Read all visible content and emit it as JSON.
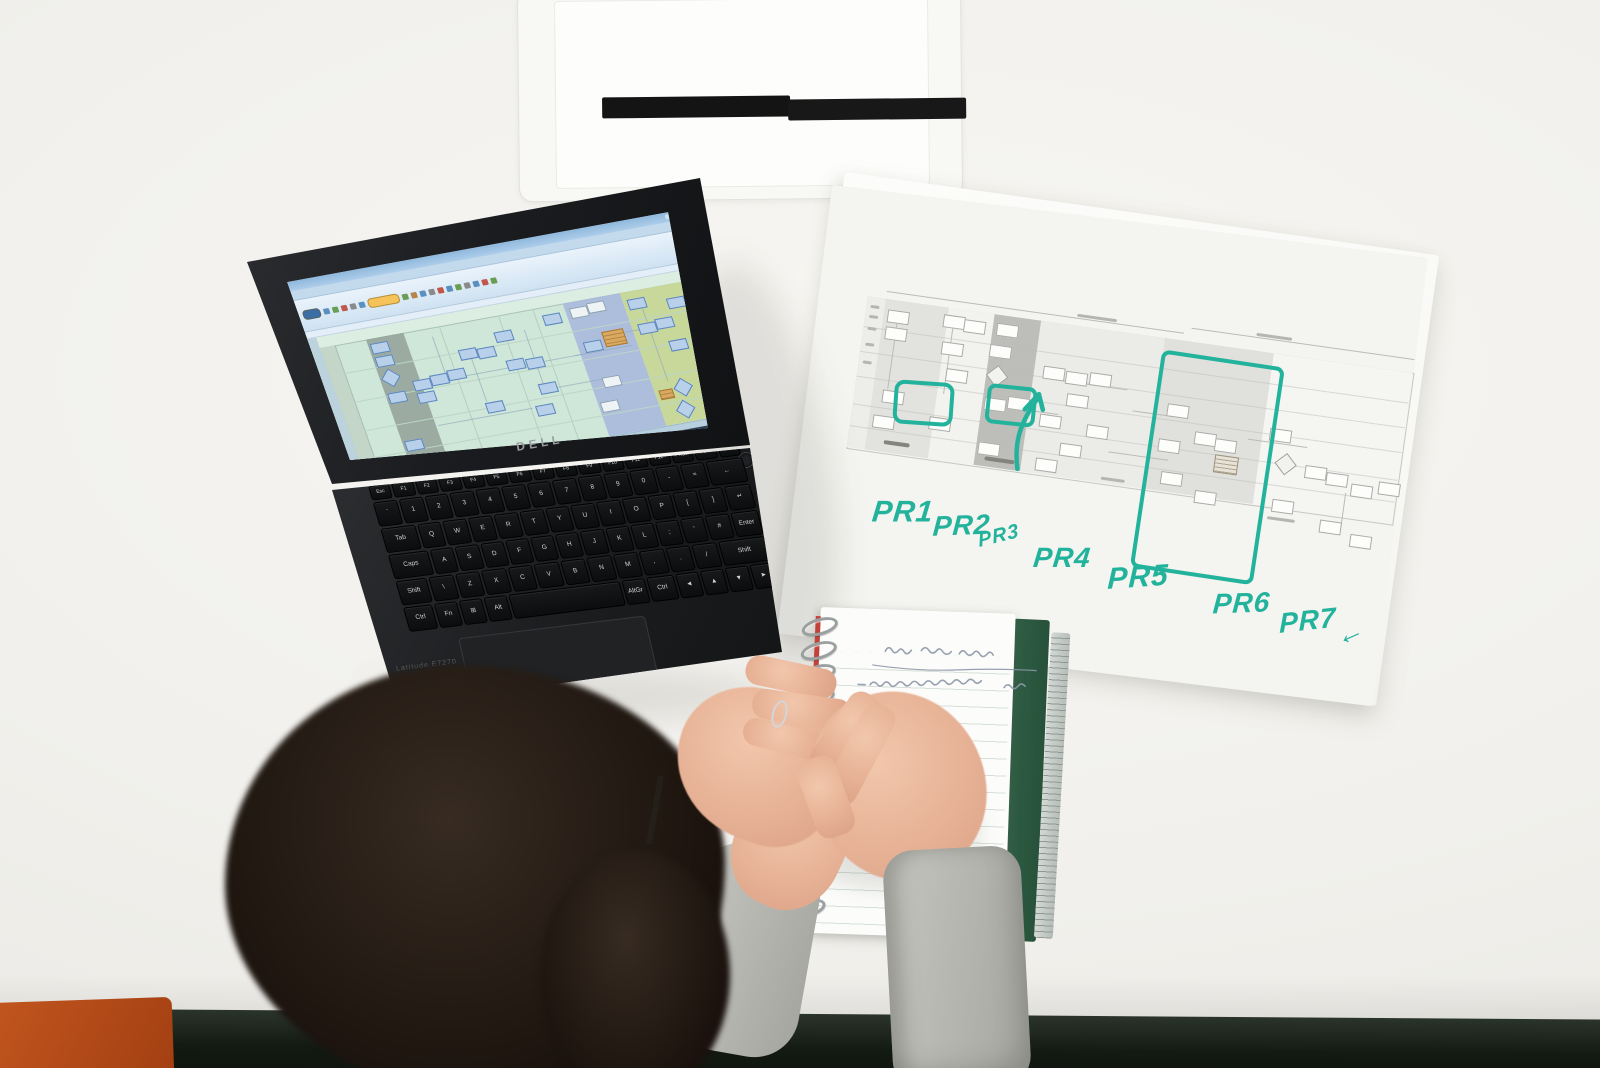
{
  "scene": {
    "description": "Overhead photo of a person taking handwritten notes at a white desk beside a Dell laptop displaying a swimlane process flowchart, next to a printed process map annotated with teal marker labels PR1 through PR7"
  },
  "palette": {
    "desk": "#f1f0ec",
    "desk_edge": "#131a12",
    "chair": "#b8501f",
    "marker_teal": "#23b39c",
    "skin": "#e7b296",
    "sleeve": "#b7b7b1",
    "hair": "#241b14",
    "pen": "#141414",
    "notebook_cover": "#2e5c43",
    "notebook_ink": "#8e98a9"
  },
  "laptop": {
    "brand_logo": "DELL",
    "model_label": "Latitude E7270",
    "screen": {
      "chrome_color": "#9dc0e0",
      "canvas_color": "#cfe7d8",
      "ribbon_icons": [
        {
          "c": "#3a6ea5",
          "w": 16,
          "pill": true
        },
        {
          "c": "#5b8fc0"
        },
        {
          "c": "#6b9e55"
        },
        {
          "c": "#c0574a"
        },
        {
          "c": "#8a8a8a"
        },
        {
          "c": "#5b8fc0"
        },
        {
          "c": "#f5c35a",
          "w": 30,
          "pill": true
        },
        {
          "c": "#6b9e55"
        },
        {
          "c": "#b5864a"
        },
        {
          "c": "#5b8fc0"
        },
        {
          "c": "#8a8a8a"
        },
        {
          "c": "#c0574a"
        },
        {
          "c": "#5b8fc0"
        },
        {
          "c": "#6b9e55"
        },
        {
          "c": "#8a8a8a"
        },
        {
          "c": "#5b8fc0"
        },
        {
          "c": "#c0574a"
        },
        {
          "c": "#6b9e55"
        }
      ],
      "lanes": [
        {
          "x": 56,
          "w": 38,
          "c": "#96a49c"
        },
        {
          "x": 256,
          "w": 58,
          "c": "#a9b9de"
        },
        {
          "x": 314,
          "w": 86,
          "c": "#c6d693"
        }
      ],
      "gridx": [
        130,
        190,
        225
      ],
      "gridy": [
        40,
        70,
        100,
        128
      ],
      "shapes": [
        {
          "x": 58,
          "y": 16,
          "t": "b"
        },
        {
          "x": 58,
          "y": 30,
          "t": "b"
        },
        {
          "x": 60,
          "y": 46,
          "t": "d"
        },
        {
          "x": 58,
          "y": 68,
          "t": "b"
        },
        {
          "x": 58,
          "y": 118,
          "t": "b"
        },
        {
          "x": 86,
          "y": 60,
          "t": "b"
        },
        {
          "x": 86,
          "y": 73,
          "t": "b"
        },
        {
          "x": 104,
          "y": 58,
          "t": "b"
        },
        {
          "x": 122,
          "y": 56,
          "t": "b"
        },
        {
          "x": 140,
          "y": 38,
          "t": "b"
        },
        {
          "x": 158,
          "y": 40,
          "t": "b"
        },
        {
          "x": 180,
          "y": 27,
          "t": "b"
        },
        {
          "x": 182,
          "y": 57,
          "t": "b"
        },
        {
          "x": 201,
          "y": 59,
          "t": "b"
        },
        {
          "x": 205,
          "y": 86,
          "t": "b"
        },
        {
          "x": 195,
          "y": 107,
          "t": "b"
        },
        {
          "x": 148,
          "y": 95,
          "t": "b"
        },
        {
          "x": 232,
          "y": 19,
          "t": "b"
        },
        {
          "x": 260,
          "y": 17,
          "t": "w"
        },
        {
          "x": 278,
          "y": 15,
          "t": "w"
        },
        {
          "x": 262,
          "y": 53,
          "t": "b"
        },
        {
          "x": 283,
          "y": 46,
          "t": "o"
        },
        {
          "x": 268,
          "y": 91,
          "t": "w"
        },
        {
          "x": 258,
          "y": 115,
          "t": "w"
        },
        {
          "x": 318,
          "y": 19,
          "t": "b"
        },
        {
          "x": 320,
          "y": 45,
          "t": "b"
        },
        {
          "x": 338,
          "y": 43,
          "t": "b"
        },
        {
          "x": 356,
          "y": 25,
          "t": "b"
        },
        {
          "x": 344,
          "y": 67,
          "t": "b"
        },
        {
          "x": 318,
          "y": 114,
          "t": "o2"
        },
        {
          "x": 336,
          "y": 108,
          "t": "d"
        },
        {
          "x": 362,
          "y": 104,
          "t": "b"
        },
        {
          "x": 376,
          "y": 37,
          "t": "b"
        },
        {
          "x": 331,
          "y": 130,
          "t": "d"
        }
      ],
      "lines": [
        {
          "x": 90,
          "y": 64,
          "w": 168,
          "h": 1
        },
        {
          "x": 120,
          "y": 20,
          "w": 1,
          "h": 42
        },
        {
          "x": 210,
          "y": 30,
          "w": 1,
          "h": 58
        },
        {
          "x": 250,
          "y": 64,
          "w": 58,
          "h": 1
        },
        {
          "x": 306,
          "y": 50,
          "w": 40,
          "h": 1
        },
        {
          "x": 330,
          "y": 30,
          "w": 1,
          "h": 76
        },
        {
          "x": 370,
          "y": 46,
          "w": 1,
          "h": 58
        },
        {
          "x": 150,
          "y": 46,
          "w": 1,
          "h": 48
        },
        {
          "x": 96,
          "y": 108,
          "w": 96,
          "h": 1
        },
        {
          "x": 222,
          "y": 92,
          "w": 56,
          "h": 1
        }
      ],
      "taskbar_color": "#2e4058",
      "task_dots": [
        "#4a90d9",
        "#e8a33d",
        "#6bbf6b",
        "#d95f4a",
        "#8ab4d8",
        "#c8c8c8"
      ]
    },
    "keyboard": {
      "rows": [
        {
          "h": 15,
          "keys": [
            {
              "t": "Esc"
            },
            {
              "t": "F1"
            },
            {
              "t": "F2"
            },
            {
              "t": "F3"
            },
            {
              "t": "F4"
            },
            {
              "t": "F5"
            },
            {
              "t": "F6"
            },
            {
              "t": "F7"
            },
            {
              "t": "F8"
            },
            {
              "t": "F9"
            },
            {
              "t": "F10"
            },
            {
              "t": "F11"
            },
            {
              "t": "F12"
            },
            {
              "t": "PrtScr"
            },
            {
              "t": "Insert"
            },
            {
              "t": "Delete"
            }
          ]
        },
        {
          "h": 25,
          "keys": [
            {
              "t": "`"
            },
            {
              "t": "1"
            },
            {
              "t": "2"
            },
            {
              "t": "3"
            },
            {
              "t": "4"
            },
            {
              "t": "5"
            },
            {
              "t": "6"
            },
            {
              "t": "7"
            },
            {
              "t": "8"
            },
            {
              "t": "9"
            },
            {
              "t": "0"
            },
            {
              "t": "-"
            },
            {
              "t": "="
            },
            {
              "t": "←",
              "w": 1.6
            }
          ]
        },
        {
          "h": 25,
          "keys": [
            {
              "t": "Tab",
              "w": 1.5
            },
            {
              "t": "Q"
            },
            {
              "t": "W"
            },
            {
              "t": "E"
            },
            {
              "t": "R"
            },
            {
              "t": "T"
            },
            {
              "t": "Y"
            },
            {
              "t": "U"
            },
            {
              "t": "I"
            },
            {
              "t": "O"
            },
            {
              "t": "P"
            },
            {
              "t": "["
            },
            {
              "t": "]"
            },
            {
              "t": "↵",
              "w": 1.1
            }
          ]
        },
        {
          "h": 25,
          "keys": [
            {
              "t": "Caps",
              "w": 1.8
            },
            {
              "t": "A"
            },
            {
              "t": "S"
            },
            {
              "t": "D"
            },
            {
              "t": "F"
            },
            {
              "t": "G"
            },
            {
              "t": "H"
            },
            {
              "t": "J"
            },
            {
              "t": "K"
            },
            {
              "t": "L"
            },
            {
              "t": ";"
            },
            {
              "t": "'"
            },
            {
              "t": "#"
            },
            {
              "t": "Enter",
              "w": 1.2
            }
          ]
        },
        {
          "h": 25,
          "keys": [
            {
              "t": "Shift",
              "w": 1.3
            },
            {
              "t": "\\"
            },
            {
              "t": "Z"
            },
            {
              "t": "X"
            },
            {
              "t": "C"
            },
            {
              "t": "V"
            },
            {
              "t": "B"
            },
            {
              "t": "N"
            },
            {
              "t": "M"
            },
            {
              "t": ","
            },
            {
              "t": "."
            },
            {
              "t": "/"
            },
            {
              "t": "Shift",
              "w": 2.0
            }
          ]
        },
        {
          "h": 25,
          "keys": [
            {
              "t": "Ctrl",
              "w": 1.3
            },
            {
              "t": "Fn"
            },
            {
              "t": "⊞"
            },
            {
              "t": "Alt"
            },
            {
              "t": "",
              "w": 5.2
            },
            {
              "t": "AltGr"
            },
            {
              "t": "Ctrl",
              "w": 1.2
            },
            {
              "t": "◄"
            },
            {
              "t": "▲"
            },
            {
              "t": "▼"
            },
            {
              "t": "►"
            }
          ]
        }
      ]
    }
  },
  "paper": {
    "marker_color": "#23b39c",
    "annotations": [
      {
        "text": "PR1",
        "x": 74,
        "y": 312,
        "s": 30,
        "r": -8
      },
      {
        "text": "PR2",
        "x": 136,
        "y": 318,
        "s": 28,
        "r": -10
      },
      {
        "text": "PR3",
        "x": 182,
        "y": 328,
        "s": 20,
        "r": -22
      },
      {
        "text": "PR4",
        "x": 240,
        "y": 336,
        "s": 28,
        "r": -8
      },
      {
        "text": "PR5",
        "x": 316,
        "y": 344,
        "s": 30,
        "r": -12
      },
      {
        "text": "PR6",
        "x": 424,
        "y": 356,
        "s": 28,
        "r": -10
      },
      {
        "text": "PR7",
        "x": 492,
        "y": 364,
        "s": 28,
        "r": -14
      },
      {
        "text": "←",
        "x": 550,
        "y": 370,
        "s": 28,
        "r": -32
      }
    ],
    "diagram": {
      "band": {
        "x": 40,
        "y": 120,
        "w": 550,
        "h": 152
      },
      "lanes": [
        {
          "x": 40,
          "w": 18,
          "c": "#ededea"
        },
        {
          "x": 58,
          "w": 64,
          "c": "#e2e2df"
        },
        {
          "x": 122,
          "w": 46,
          "c": "#f2f2ef"
        },
        {
          "x": 168,
          "w": 47,
          "c": "#bdbdb9"
        },
        {
          "x": 215,
          "w": 125,
          "c": "#ebebe8"
        },
        {
          "x": 340,
          "w": 110,
          "c": "#e0e0dd"
        },
        {
          "x": 450,
          "w": 140,
          "c": "#f5f5f2"
        }
      ],
      "hlines": [
        150,
        175,
        200,
        228,
        250
      ],
      "shapes": [
        {
          "x": 62,
          "y": 130
        },
        {
          "x": 62,
          "y": 147
        },
        {
          "x": 68,
          "y": 210
        },
        {
          "x": 62,
          "y": 236
        },
        {
          "x": 118,
          "y": 127
        },
        {
          "x": 139,
          "y": 129
        },
        {
          "x": 120,
          "y": 154
        },
        {
          "x": 128,
          "y": 180
        },
        {
          "x": 118,
          "y": 230
        },
        {
          "x": 172,
          "y": 128
        },
        {
          "x": 168,
          "y": 150
        },
        {
          "x": 171,
          "y": 173,
          "t": "d"
        },
        {
          "x": 170,
          "y": 203
        },
        {
          "x": 170,
          "y": 248
        },
        {
          "x": 193,
          "y": 199
        },
        {
          "x": 224,
          "y": 164
        },
        {
          "x": 247,
          "y": 166
        },
        {
          "x": 271,
          "y": 164
        },
        {
          "x": 251,
          "y": 188
        },
        {
          "x": 227,
          "y": 212
        },
        {
          "x": 275,
          "y": 216
        },
        {
          "x": 251,
          "y": 238
        },
        {
          "x": 229,
          "y": 256
        },
        {
          "x": 352,
          "y": 184
        },
        {
          "x": 348,
          "y": 220
        },
        {
          "x": 383,
          "y": 208
        },
        {
          "x": 404,
          "y": 212
        },
        {
          "x": 406,
          "y": 228,
          "t": "o"
        },
        {
          "x": 355,
          "y": 252
        },
        {
          "x": 391,
          "y": 266
        },
        {
          "x": 457,
          "y": 194
        },
        {
          "x": 469,
          "y": 220,
          "t": "d"
        },
        {
          "x": 497,
          "y": 226
        },
        {
          "x": 519,
          "y": 230
        },
        {
          "x": 545,
          "y": 238
        },
        {
          "x": 469,
          "y": 264
        },
        {
          "x": 519,
          "y": 278
        },
        {
          "x": 551,
          "y": 288
        },
        {
          "x": 572,
          "y": 232
        }
      ],
      "lines": [
        {
          "x": 72,
          "y": 143,
          "w": 1,
          "h": 66
        },
        {
          "x": 128,
          "y": 140,
          "w": 1,
          "h": 66
        },
        {
          "x": 181,
          "y": 143,
          "w": 1,
          "h": 58
        },
        {
          "x": 240,
          "y": 176,
          "w": 70,
          "h": 1
        },
        {
          "x": 318,
          "y": 196,
          "w": 46,
          "h": 1
        },
        {
          "x": 436,
          "y": 208,
          "w": 60,
          "h": 1
        },
        {
          "x": 460,
          "y": 232,
          "w": 1,
          "h": 46
        },
        {
          "x": 540,
          "y": 248,
          "w": 1,
          "h": 38
        },
        {
          "x": 205,
          "y": 210,
          "w": 40,
          "h": 1
        },
        {
          "x": 300,
          "y": 240,
          "w": 60,
          "h": 1
        },
        {
          "x": 58,
          "y": 112,
          "w": 300,
          "h": 1
        },
        {
          "x": 365,
          "y": 106,
          "w": 225,
          "h": 1
        }
      ],
      "marks": [
        {
          "x": 44,
          "y": 128,
          "w": 9,
          "h": 3
        },
        {
          "x": 44,
          "y": 138,
          "w": 9,
          "h": 3
        },
        {
          "x": 44,
          "y": 150,
          "w": 9,
          "h": 3
        },
        {
          "x": 44,
          "y": 166,
          "w": 9,
          "h": 3
        },
        {
          "x": 44,
          "y": 184,
          "w": 9,
          "h": 3
        },
        {
          "x": 76,
          "y": 260,
          "w": 26,
          "h": 4,
          "dark": true
        },
        {
          "x": 178,
          "y": 262,
          "w": 30,
          "h": 4,
          "dark": true
        },
        {
          "x": 296,
          "y": 266,
          "w": 24,
          "h": 3
        },
        {
          "x": 466,
          "y": 282,
          "w": 28,
          "h": 3
        },
        {
          "x": 250,
          "y": 108,
          "w": 40,
          "h": 3
        },
        {
          "x": 430,
          "y": 102,
          "w": 36,
          "h": 3
        }
      ]
    }
  },
  "notebook": {
    "page_color": "#fcfcfa",
    "rule_color": "#d6dfd9",
    "cover_color": "#2e5c43",
    "stripe_color": "#c2423a",
    "coil_count": 13,
    "ink_color": "#8e98a9",
    "content_note": "illegible cursive notes: underlined title line and three short dash bullets"
  }
}
